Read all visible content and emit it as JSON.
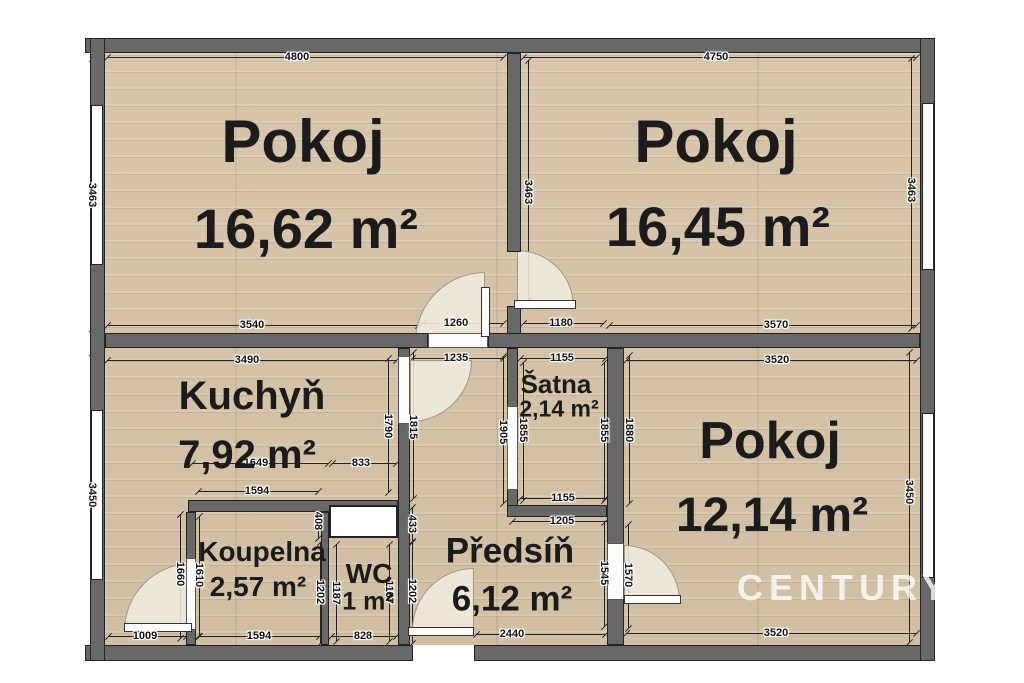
{
  "watermark": {
    "text": "CENTURY 21"
  },
  "palette": {
    "wall": "#686868",
    "floor": "#d6c3a7",
    "dim_color": "#111111",
    "arc_fill": "#f1eade"
  },
  "rooms": [
    {
      "id": "pokoj-1",
      "name": "Pokoj",
      "area": "16,62 m²",
      "name_pos": [
        303,
        142
      ],
      "area_pos": [
        306,
        229
      ],
      "name_size": 60,
      "area_size": 56
    },
    {
      "id": "pokoj-2",
      "name": "Pokoj",
      "area": "16,45 m²",
      "name_pos": [
        716,
        142
      ],
      "area_pos": [
        718,
        227
      ],
      "name_size": 60,
      "area_size": 56
    },
    {
      "id": "kuchyn",
      "name": "Kuchyň",
      "area": "7,92 m²",
      "name_pos": [
        252,
        396
      ],
      "area_pos": [
        247,
        455
      ],
      "name_size": 40,
      "area_size": 40
    },
    {
      "id": "satna",
      "name": "Šatna",
      "area": "2,14 m²",
      "name_pos": [
        556,
        384
      ],
      "area_pos": [
        559,
        409
      ],
      "name_size": 26,
      "area_size": 23
    },
    {
      "id": "pokoj-3",
      "name": "Pokoj",
      "area": "12,14 m²",
      "name_pos": [
        770,
        441
      ],
      "area_pos": [
        772,
        516
      ],
      "name_size": 52,
      "area_size": 48
    },
    {
      "id": "koupelna",
      "name": "Koupelna",
      "area": "2,57 m²",
      "name_pos": [
        262,
        552
      ],
      "area_pos": [
        258,
        587
      ],
      "name_size": 28,
      "area_size": 28
    },
    {
      "id": "wc",
      "name": "WC",
      "area": "1 m²",
      "name_pos": [
        369,
        574
      ],
      "area_pos": [
        368,
        602
      ],
      "name_size": 28,
      "area_size": 25
    },
    {
      "id": "predsin",
      "name": "Předsíň",
      "area": "6,12 m²",
      "name_pos": [
        510,
        551
      ],
      "area_pos": [
        512,
        599
      ],
      "name_size": 35,
      "area_size": 35
    }
  ],
  "dimensions": [
    {
      "t": "4800",
      "x": 297,
      "y": 57,
      "r": 0,
      "l": [
        107,
        57,
        503,
        57
      ]
    },
    {
      "t": "4750",
      "x": 716,
      "y": 57,
      "r": 0,
      "l": [
        523,
        57,
        916,
        57
      ]
    },
    {
      "t": "3463",
      "x": 92,
      "y": 195,
      "r": 90,
      "l": [
        92,
        58,
        92,
        328
      ]
    },
    {
      "t": "3463",
      "x": 528,
      "y": 192,
      "r": 90,
      "l": [
        528,
        60,
        528,
        300
      ]
    },
    {
      "t": "3463",
      "x": 911,
      "y": 190,
      "r": 90,
      "l": [
        911,
        58,
        911,
        328
      ]
    },
    {
      "t": "3540",
      "x": 252,
      "y": 325,
      "r": 0,
      "l": [
        107,
        325,
        418,
        325
      ]
    },
    {
      "t": "1260",
      "x": 456,
      "y": 323,
      "r": 0,
      "l": [
        422,
        323,
        503,
        323
      ]
    },
    {
      "t": "1180",
      "x": 561,
      "y": 323,
      "r": 0,
      "l": [
        523,
        323,
        603,
        323
      ]
    },
    {
      "t": "3570",
      "x": 776,
      "y": 325,
      "r": 0,
      "l": [
        609,
        325,
        916,
        325
      ]
    },
    {
      "t": "3490",
      "x": 247,
      "y": 360,
      "r": 0,
      "l": [
        107,
        360,
        396,
        360
      ]
    },
    {
      "t": "1235",
      "x": 456,
      "y": 358,
      "r": 0,
      "l": [
        412,
        358,
        503,
        358
      ]
    },
    {
      "t": "1155",
      "x": 562,
      "y": 358,
      "r": 0,
      "l": [
        520,
        358,
        605,
        358
      ]
    },
    {
      "t": "3520",
      "x": 777,
      "y": 360,
      "r": 0,
      "l": [
        626,
        360,
        916,
        360
      ]
    },
    {
      "t": "3450",
      "x": 92,
      "y": 495,
      "r": 90,
      "l": [
        92,
        352,
        92,
        642
      ]
    },
    {
      "t": "3450",
      "x": 909,
      "y": 492,
      "r": 90,
      "l": [
        909,
        352,
        909,
        642
      ]
    },
    {
      "t": "1790",
      "x": 388,
      "y": 426,
      "r": 90,
      "l": [
        388,
        358,
        388,
        492
      ]
    },
    {
      "t": "1815",
      "x": 413,
      "y": 427,
      "r": 90,
      "l": [
        413,
        352,
        413,
        498
      ]
    },
    {
      "t": "1905",
      "x": 503,
      "y": 432,
      "r": 90,
      "l": [
        503,
        356,
        503,
        503
      ]
    },
    {
      "t": "1855",
      "x": 523,
      "y": 430,
      "r": 90,
      "l": [
        523,
        362,
        523,
        500
      ]
    },
    {
      "t": "1855",
      "x": 604,
      "y": 430,
      "r": 90,
      "l": [
        604,
        362,
        604,
        500
      ]
    },
    {
      "t": "1880",
      "x": 629,
      "y": 430,
      "r": 90,
      "l": [
        629,
        355,
        629,
        503
      ]
    },
    {
      "t": "1649",
      "x": 256,
      "y": 463,
      "r": 0,
      "l": [
        192,
        463,
        328,
        463
      ]
    },
    {
      "t": "833",
      "x": 361,
      "y": 463,
      "r": 0,
      "l": [
        332,
        463,
        396,
        463
      ]
    },
    {
      "t": "1594",
      "x": 257,
      "y": 491,
      "r": 0,
      "l": [
        198,
        491,
        318,
        491
      ]
    },
    {
      "t": "408",
      "x": 318,
      "y": 521,
      "r": 90,
      "l": [
        318,
        505,
        318,
        538
      ]
    },
    {
      "t": "433",
      "x": 412,
      "y": 524,
      "r": 90,
      "l": [
        412,
        507,
        412,
        541
      ]
    },
    {
      "t": "1155",
      "x": 563,
      "y": 498,
      "r": 0,
      "l": [
        520,
        498,
        605,
        498
      ]
    },
    {
      "t": "1205",
      "x": 562,
      "y": 521,
      "r": 0,
      "l": [
        512,
        521,
        610,
        521
      ]
    },
    {
      "t": "1660",
      "x": 180,
      "y": 574,
      "r": 90,
      "l": [
        180,
        514,
        180,
        638
      ]
    },
    {
      "t": "1610",
      "x": 199,
      "y": 575,
      "r": 90,
      "l": [
        199,
        516,
        199,
        636
      ]
    },
    {
      "t": "1202",
      "x": 320,
      "y": 592,
      "r": 90,
      "l": [
        320,
        542,
        320,
        643
      ]
    },
    {
      "t": "1187",
      "x": 336,
      "y": 593,
      "r": 90,
      "l": [
        336,
        544,
        336,
        641
      ]
    },
    {
      "t": "1187",
      "x": 389,
      "y": 592,
      "r": 90,
      "l": [
        389,
        544,
        389,
        641
      ]
    },
    {
      "t": "1202",
      "x": 412,
      "y": 591,
      "r": 90,
      "l": [
        412,
        542,
        412,
        643
      ]
    },
    {
      "t": "1545",
      "x": 604,
      "y": 573,
      "r": 90,
      "l": [
        604,
        522,
        604,
        626
      ]
    },
    {
      "t": "1570",
      "x": 628,
      "y": 575,
      "r": 90,
      "l": [
        628,
        524,
        628,
        628
      ]
    },
    {
      "t": "1009",
      "x": 145,
      "y": 636,
      "r": 0,
      "l": [
        108,
        636,
        186,
        636
      ]
    },
    {
      "t": "1594",
      "x": 259,
      "y": 636,
      "r": 0,
      "l": [
        198,
        636,
        319,
        636
      ]
    },
    {
      "t": "828",
      "x": 363,
      "y": 636,
      "r": 0,
      "l": [
        331,
        636,
        396,
        636
      ]
    },
    {
      "t": "2440",
      "x": 512,
      "y": 634,
      "r": 0,
      "l": [
        476,
        634,
        605,
        634
      ]
    },
    {
      "t": "3520",
      "x": 776,
      "y": 633,
      "r": 0,
      "l": [
        626,
        633,
        916,
        633
      ]
    }
  ]
}
